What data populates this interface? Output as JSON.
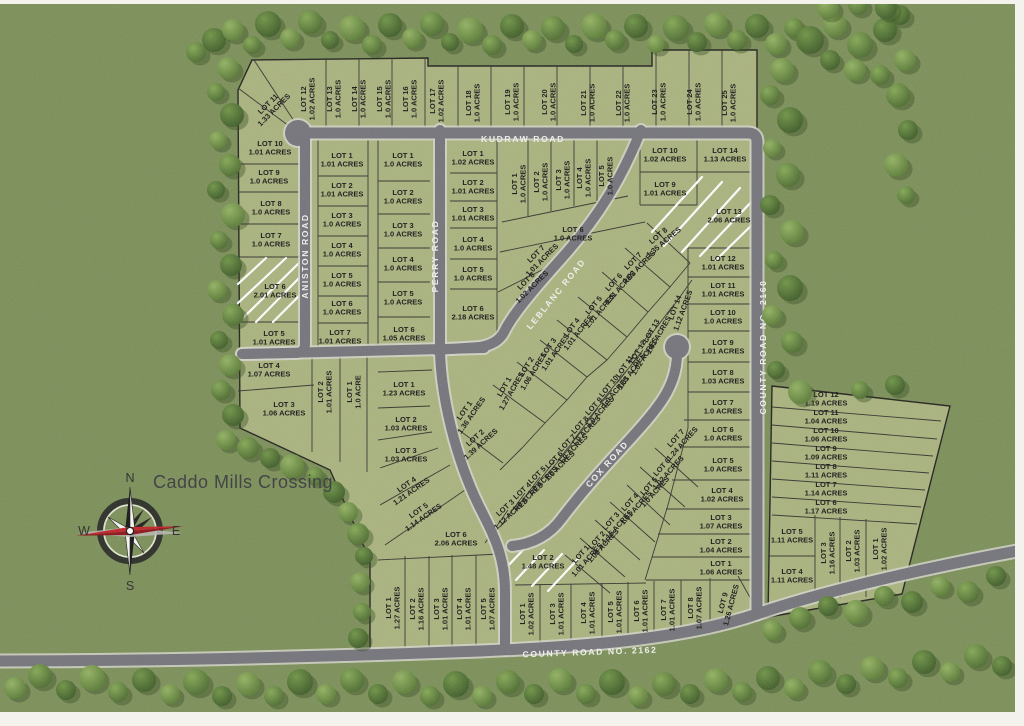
{
  "title": "Caddo Mills Crossing",
  "compass": {
    "n": "N",
    "s": "S",
    "e": "E",
    "w": "W"
  },
  "roads": [
    {
      "name": "KUDRAW  ROAD",
      "x": 523,
      "y": 139,
      "r": 0
    },
    {
      "name": "ANISTON ROAD",
      "x": 305,
      "y": 256,
      "r": -90
    },
    {
      "name": "PERRY  ROAD",
      "x": 435,
      "y": 256,
      "r": -90
    },
    {
      "name": "LEBLANC ROAD",
      "x": 556,
      "y": 294,
      "r": -51
    },
    {
      "name": "COX ROAD",
      "x": 607,
      "y": 464,
      "r": -48
    },
    {
      "name": "COUNTY ROAD NO. 2160",
      "x": 763,
      "y": 347,
      "r": -90
    },
    {
      "name": "COUNTY ROAD NO. 2162",
      "x": 590,
      "y": 652,
      "r": -2
    }
  ],
  "lots": [
    {
      "t": "LOT 11",
      "a": "1.33 ACRES",
      "x": 271,
      "y": 107,
      "r": -45
    },
    {
      "t": "LOT 12",
      "a": "1.02 ACRES",
      "x": 308,
      "y": 99,
      "r": -90
    },
    {
      "t": "LOT 13",
      "a": "1.0 ACRES",
      "x": 334,
      "y": 99,
      "r": -90
    },
    {
      "t": "LOT 14",
      "a": "1.0 ACRES",
      "x": 359,
      "y": 99,
      "r": -90
    },
    {
      "t": "LOT 15",
      "a": "1.0 ACRES",
      "x": 384,
      "y": 99,
      "r": -90
    },
    {
      "t": "LOT 16",
      "a": "1.0 ACRES",
      "x": 410,
      "y": 99,
      "r": -90
    },
    {
      "t": "LOT 17",
      "a": "1.02 ACRES",
      "x": 437,
      "y": 101,
      "r": -90
    },
    {
      "t": "LOT 18",
      "a": "1.0 ACRES",
      "x": 473,
      "y": 103,
      "r": -90
    },
    {
      "t": "LOT 19",
      "a": "1.0 ACRES",
      "x": 512,
      "y": 102,
      "r": -90
    },
    {
      "t": "LOT 20",
      "a": "1.0 ACRES",
      "x": 549,
      "y": 102,
      "r": -90
    },
    {
      "t": "LOT 21",
      "a": "1.0 ACRES",
      "x": 588,
      "y": 103,
      "r": -90
    },
    {
      "t": "LOT 22",
      "a": "1.0 ACRES",
      "x": 623,
      "y": 103,
      "r": -90
    },
    {
      "t": "LOT 23",
      "a": "1.0 ACRES",
      "x": 659,
      "y": 102,
      "r": -90
    },
    {
      "t": "LOT 24",
      "a": "1.0 ACRES",
      "x": 694,
      "y": 102,
      "r": -90
    },
    {
      "t": "LOT 25",
      "a": "1.0 ACRES",
      "x": 729,
      "y": 103,
      "r": -90
    },
    {
      "t": "LOT 10",
      "a": "1.01 ACRES",
      "x": 270,
      "y": 148,
      "r": 0
    },
    {
      "t": "LOT 9",
      "a": "1.0 ACRES",
      "x": 269,
      "y": 177,
      "r": 0
    },
    {
      "t": "LOT 8",
      "a": "1.0 ACRES",
      "x": 271,
      "y": 208,
      "r": 0
    },
    {
      "t": "LOT 7",
      "a": "1.0 ACRES",
      "x": 271,
      "y": 240,
      "r": 0
    },
    {
      "t": "LOT 6",
      "a": "2.01 ACRES",
      "x": 275,
      "y": 291,
      "r": 0
    },
    {
      "t": "LOT 5",
      "a": "1.01 ACRES",
      "x": 274,
      "y": 338,
      "r": 0
    },
    {
      "t": "LOT 4",
      "a": "1.07 ACRES",
      "x": 269,
      "y": 370,
      "r": 0
    },
    {
      "t": "LOT 3",
      "a": "1.06 ACRES",
      "x": 284,
      "y": 409,
      "r": 0
    },
    {
      "t": "LOT 2",
      "a": "1.01 ACRES",
      "x": 325,
      "y": 392,
      "r": -90
    },
    {
      "t": "LOT 1",
      "a": "1.0 ACRE",
      "x": 354,
      "y": 392,
      "r": -90
    },
    {
      "t": "LOT 1",
      "a": "1.01 ACRES",
      "x": 342,
      "y": 160,
      "r": 0
    },
    {
      "t": "LOT 2",
      "a": "1.01 ACRES",
      "x": 342,
      "y": 190,
      "r": 0
    },
    {
      "t": "LOT 3",
      "a": "1.0 ACRES",
      "x": 342,
      "y": 220,
      "r": 0
    },
    {
      "t": "LOT 4",
      "a": "1.0 ACRES",
      "x": 342,
      "y": 250,
      "r": 0
    },
    {
      "t": "LOT 5",
      "a": "1.0 ACRES",
      "x": 342,
      "y": 280,
      "r": 0
    },
    {
      "t": "LOT 6",
      "a": "1.0 ACRES",
      "x": 342,
      "y": 308,
      "r": 0
    },
    {
      "t": "LOT 7",
      "a": "1.01 ACRES",
      "x": 340,
      "y": 337,
      "r": 0
    },
    {
      "t": "LOT 1",
      "a": "1.0 ACRES",
      "x": 403,
      "y": 160,
      "r": 0
    },
    {
      "t": "LOT 2",
      "a": "1.0 ACRES",
      "x": 403,
      "y": 197,
      "r": 0
    },
    {
      "t": "LOT 3",
      "a": "1.0 ACRES",
      "x": 403,
      "y": 230,
      "r": 0
    },
    {
      "t": "LOT 4",
      "a": "1.0 ACRES",
      "x": 403,
      "y": 264,
      "r": 0
    },
    {
      "t": "LOT 5",
      "a": "1.0 ACRES",
      "x": 403,
      "y": 298,
      "r": 0
    },
    {
      "t": "LOT 6",
      "a": "1.05 ACRES",
      "x": 404,
      "y": 334,
      "r": 0
    },
    {
      "t": "LOT 1",
      "a": "1.02 ACRES",
      "x": 473,
      "y": 158,
      "r": 0
    },
    {
      "t": "LOT 2",
      "a": "1.01 ACRES",
      "x": 473,
      "y": 187,
      "r": 0
    },
    {
      "t": "LOT 3",
      "a": "1.01 ACRES",
      "x": 473,
      "y": 214,
      "r": 0
    },
    {
      "t": "LOT 4",
      "a": "1.0 ACRES",
      "x": 473,
      "y": 244,
      "r": 0
    },
    {
      "t": "LOT 5",
      "a": "1.0 ACRES",
      "x": 473,
      "y": 274,
      "r": 0
    },
    {
      "t": "LOT 6",
      "a": "2.18 ACRES",
      "x": 473,
      "y": 313,
      "r": 0
    },
    {
      "t": "LOT 1",
      "a": "1.0 ACRES",
      "x": 519,
      "y": 184,
      "r": -90
    },
    {
      "t": "LOT 2",
      "a": "1.0 ACRES",
      "x": 541,
      "y": 182,
      "r": -90
    },
    {
      "t": "LOT 3",
      "a": "1.0 ACRES",
      "x": 563,
      "y": 180,
      "r": -90
    },
    {
      "t": "LOT 4",
      "a": "1.0 ACRES",
      "x": 584,
      "y": 178,
      "r": -90
    },
    {
      "t": "LOT 5",
      "a": "1.0 ACRES",
      "x": 606,
      "y": 176,
      "r": -90
    },
    {
      "t": "LOT 6",
      "a": "1.0 ACRES",
      "x": 573,
      "y": 234,
      "r": 0
    },
    {
      "t": "LOT 7",
      "a": "1.01 ACRES",
      "x": 539,
      "y": 257,
      "r": -45
    },
    {
      "t": "LOT 8",
      "a": "1.02 ACRES",
      "x": 529,
      "y": 284,
      "r": -45
    },
    {
      "t": "LOT 8",
      "a": "1.35 ACRES",
      "x": 661,
      "y": 239,
      "r": -40
    },
    {
      "t": "LOT 7",
      "a": "1.02 ACRES",
      "x": 636,
      "y": 264,
      "r": -45
    },
    {
      "t": "LOT 6",
      "a": "1.01 ACRES",
      "x": 617,
      "y": 285,
      "r": -48
    },
    {
      "t": "LOT 5",
      "a": "1.01 ACRES",
      "x": 597,
      "y": 308,
      "r": -50
    },
    {
      "t": "LOT 4",
      "a": "1.01 ACRES",
      "x": 575,
      "y": 330,
      "r": -52
    },
    {
      "t": "LOT 3",
      "a": "1.01 ACRES",
      "x": 552,
      "y": 350,
      "r": -55
    },
    {
      "t": "LOT 2",
      "a": "1.06 ACRES",
      "x": 530,
      "y": 369,
      "r": -58
    },
    {
      "t": "LOT 1",
      "a": "1.27 ACRES",
      "x": 508,
      "y": 389,
      "r": -60
    },
    {
      "t": "LOT 14",
      "a": "1.12 ACRES",
      "x": 679,
      "y": 309,
      "r": -70
    },
    {
      "t": "LOT 13",
      "a": "1.01 ACRES",
      "x": 655,
      "y": 333,
      "r": -60
    },
    {
      "t": "LOT 12",
      "a": "1.02 ACRES",
      "x": 641,
      "y": 354,
      "r": -58
    },
    {
      "t": "LOT 11",
      "a": "1.01 ACRES",
      "x": 628,
      "y": 369,
      "r": -55
    },
    {
      "t": "LOT 10",
      "a": "1.0 ACRES",
      "x": 612,
      "y": 389,
      "r": -50
    },
    {
      "t": "LOT 9",
      "a": "1.0 ACRES",
      "x": 597,
      "y": 409,
      "r": -48
    },
    {
      "t": "LOT 8",
      "a": "1.0 ACRES",
      "x": 583,
      "y": 428,
      "r": -46
    },
    {
      "t": "LOT 7",
      "a": "1.0 ACRES",
      "x": 570,
      "y": 446,
      "r": -45
    },
    {
      "t": "LOT 6",
      "a": "1.0 ACRES",
      "x": 557,
      "y": 463,
      "r": -45
    },
    {
      "t": "LOT 5",
      "a": "1.0 ACRES",
      "x": 540,
      "y": 478,
      "r": -44
    },
    {
      "t": "LOT 4",
      "a": "1.0 ACRES",
      "x": 525,
      "y": 494,
      "r": -43
    },
    {
      "t": "LOT 3",
      "a": "1.12 ACRES",
      "x": 508,
      "y": 511,
      "r": -42
    },
    {
      "t": "LOT 1",
      "a": "1.36 ACRES",
      "x": 468,
      "y": 413,
      "r": -55
    },
    {
      "t": "LOT 2",
      "a": "1.39 ACRES",
      "x": 478,
      "y": 441,
      "r": -42
    },
    {
      "t": "LOT 1",
      "a": "1.23 ACRES",
      "x": 404,
      "y": 389,
      "r": 0
    },
    {
      "t": "LOT 2",
      "a": "1.03 ACRES",
      "x": 406,
      "y": 424,
      "r": 0
    },
    {
      "t": "LOT 3",
      "a": "1.03 ACRES",
      "x": 406,
      "y": 455,
      "r": 0
    },
    {
      "t": "LOT 4",
      "a": "1.21 ACRES",
      "x": 409,
      "y": 488,
      "r": -35
    },
    {
      "t": "LOT 5",
      "a": "1.14 ACRES",
      "x": 421,
      "y": 514,
      "r": -35
    },
    {
      "t": "LOT 6",
      "a": "2.06 ACRES",
      "x": 456,
      "y": 539,
      "r": 0
    },
    {
      "t": "LOT 7",
      "a": "1.24 ACRES",
      "x": 679,
      "y": 441,
      "r": -48
    },
    {
      "t": "LOT 6",
      "a": "1.02 ACRES",
      "x": 665,
      "y": 470,
      "r": -48
    },
    {
      "t": "LOT 5",
      "a": "1.0 ACRES",
      "x": 652,
      "y": 489,
      "r": -48
    },
    {
      "t": "LOT 4",
      "a": "1.01 ACRES",
      "x": 633,
      "y": 505,
      "r": -48
    },
    {
      "t": "LOT 3",
      "a": "1.15 ACRES",
      "x": 614,
      "y": 524,
      "r": -48
    },
    {
      "t": "LOT 2",
      "a": "1.08 ACRES",
      "x": 600,
      "y": 543,
      "r": -48
    },
    {
      "t": "LOT 1",
      "a": "1.01 ACRES",
      "x": 584,
      "y": 557,
      "r": -48
    },
    {
      "t": "LOT 10",
      "a": "1.02 ACRES",
      "x": 665,
      "y": 155,
      "r": 0
    },
    {
      "t": "LOT 9",
      "a": "1.01 ACRES",
      "x": 665,
      "y": 189,
      "r": 0
    },
    {
      "t": "LOT 14",
      "a": "1.13 ACRES",
      "x": 725,
      "y": 155,
      "r": 0
    },
    {
      "t": "LOT 13",
      "a": "2.06 ACRES",
      "x": 729,
      "y": 216,
      "r": 0
    },
    {
      "t": "LOT 12",
      "a": "1.01 ACRES",
      "x": 723,
      "y": 263,
      "r": 0
    },
    {
      "t": "LOT 11",
      "a": "1.01 ACRES",
      "x": 723,
      "y": 290,
      "r": 0
    },
    {
      "t": "LOT 10",
      "a": "1.0 ACRES",
      "x": 723,
      "y": 317,
      "r": 0
    },
    {
      "t": "LOT 9",
      "a": "1.01 ACRES",
      "x": 723,
      "y": 347,
      "r": 0
    },
    {
      "t": "LOT 8",
      "a": "1.03 ACRES",
      "x": 723,
      "y": 377,
      "r": 0
    },
    {
      "t": "LOT 7",
      "a": "1.0 ACRES",
      "x": 723,
      "y": 407,
      "r": 0
    },
    {
      "t": "LOT 6",
      "a": "1.0 ACRES",
      "x": 723,
      "y": 434,
      "r": 0
    },
    {
      "t": "LOT 5",
      "a": "1.0 ACRES",
      "x": 723,
      "y": 465,
      "r": 0
    },
    {
      "t": "LOT 4",
      "a": "1.02 ACRES",
      "x": 722,
      "y": 495,
      "r": 0
    },
    {
      "t": "LOT 3",
      "a": "1.07 ACRES",
      "x": 721,
      "y": 522,
      "r": 0
    },
    {
      "t": "LOT 2",
      "a": "1.04 ACRES",
      "x": 721,
      "y": 546,
      "r": 0
    },
    {
      "t": "LOT 1",
      "a": "1.06 ACRES",
      "x": 721,
      "y": 568,
      "r": 0
    },
    {
      "t": "LOT 12",
      "a": "1.19 ACRES",
      "x": 826,
      "y": 399,
      "r": 0
    },
    {
      "t": "LOT 11",
      "a": "1.04 ACRES",
      "x": 826,
      "y": 417,
      "r": 0
    },
    {
      "t": "LOT 10",
      "a": "1.06 ACRES",
      "x": 826,
      "y": 435,
      "r": 0
    },
    {
      "t": "LOT 9",
      "a": "1.09 ACRES",
      "x": 826,
      "y": 453,
      "r": 0
    },
    {
      "t": "LOT 8",
      "a": "1.11 ACRES",
      "x": 826,
      "y": 471,
      "r": 0
    },
    {
      "t": "LOT 7",
      "a": "1.14 ACRES",
      "x": 826,
      "y": 489,
      "r": 0
    },
    {
      "t": "LOT 6",
      "a": "1.17 ACRES",
      "x": 826,
      "y": 507,
      "r": 0
    },
    {
      "t": "LOT 5",
      "a": "1.11 ACRES",
      "x": 792,
      "y": 536,
      "r": 0
    },
    {
      "t": "LOT 4",
      "a": "1.11 ACRES",
      "x": 792,
      "y": 576,
      "r": 0
    },
    {
      "t": "LOT 3",
      "a": "1.16 ACRES",
      "x": 828,
      "y": 553,
      "r": -90
    },
    {
      "t": "LOT 2",
      "a": "1.03 ACRES",
      "x": 853,
      "y": 551,
      "r": -90
    },
    {
      "t": "LOT 1",
      "a": "1.02 ACRES",
      "x": 880,
      "y": 549,
      "r": -90
    },
    {
      "t": "LOT 1",
      "a": "1.27 ACRES",
      "x": 393,
      "y": 608,
      "r": -90
    },
    {
      "t": "LOT 2",
      "a": "1.16 ACRES",
      "x": 417,
      "y": 609,
      "r": -90
    },
    {
      "t": "LOT 3",
      "a": "1.01 ACRES",
      "x": 441,
      "y": 609,
      "r": -90
    },
    {
      "t": "LOT 4",
      "a": "1.01 ACRES",
      "x": 464,
      "y": 609,
      "r": -90
    },
    {
      "t": "LOT 5",
      "a": "1.07 ACRES",
      "x": 488,
      "y": 609,
      "r": -90
    },
    {
      "t": "LOT 2",
      "a": "1.48 ACRES",
      "x": 543,
      "y": 562,
      "r": 0
    },
    {
      "t": "LOT 1",
      "a": "1.02 ACRES",
      "x": 527,
      "y": 614,
      "r": -90
    },
    {
      "t": "LOT 3",
      "a": "1.01 ACRES",
      "x": 557,
      "y": 614,
      "r": -90
    },
    {
      "t": "LOT 4",
      "a": "1.01 ACRES",
      "x": 588,
      "y": 613,
      "r": -90
    },
    {
      "t": "LOT 5",
      "a": "1.01 ACRES",
      "x": 615,
      "y": 612,
      "r": -90
    },
    {
      "t": "LOT 6",
      "a": "1.01 ACRES",
      "x": 641,
      "y": 611,
      "r": -90
    },
    {
      "t": "LOT 7",
      "a": "1.01 ACRES",
      "x": 668,
      "y": 610,
      "r": -90
    },
    {
      "t": "LOT 8",
      "a": "1.07 ACRES",
      "x": 695,
      "y": 608,
      "r": -90
    },
    {
      "t": "LOT 9",
      "a": "1.26 ACRES",
      "x": 727,
      "y": 604,
      "r": -75
    }
  ],
  "colors": {
    "field": "#7f925a",
    "lots": "#a9b37d",
    "road": "#73737a",
    "road_edge": "#d5d5ca",
    "boundary": "#20201c",
    "lot_line": "#33332e",
    "label": "#161616",
    "road_label": "#f2f2ee",
    "tree_dark": "#42602a",
    "tree_mid": "#5d7f38",
    "tree_light": "#7b9e4c",
    "accent_red": "#c32025",
    "title_color": "#3a3a3e",
    "frame": "#f4f2ec"
  }
}
